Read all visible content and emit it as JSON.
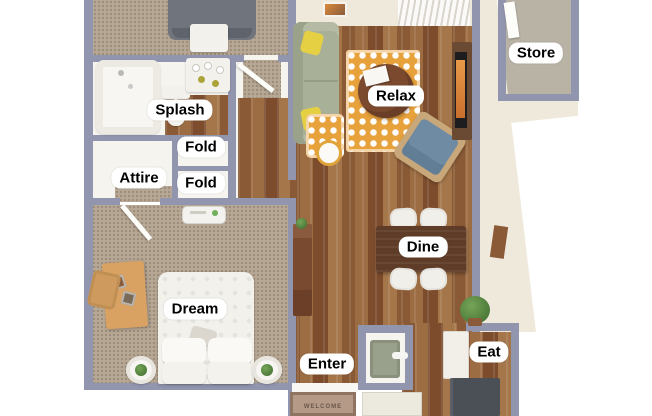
{
  "labels": {
    "store": "Store",
    "splash": "Splash",
    "fold_upper": "Fold",
    "attire": "Attire",
    "fold_lower": "Fold",
    "relax": "Relax",
    "dine": "Dine",
    "dream": "Dream",
    "enter": "Enter",
    "eat": "Eat"
  },
  "mat": {
    "text": "WELCOME"
  },
  "colors": {
    "wall": "#9295ae",
    "cream": "#efe9dc",
    "carpet": "#b7a795",
    "wood": "#95643c",
    "closet": "#f6f4ef",
    "concrete": "#b9b3a6",
    "rug": "#e8a23c",
    "sofa": "#a9b098",
    "pillow": "#e5cf43",
    "chairBlue": "#6f8ba3",
    "walnut": "#5f3c28",
    "coffee": "#7b4a2e",
    "bedGray": "#70747c",
    "desk": "#d9a263",
    "dresser": "#7a4a30",
    "plant": "#4d7c3a",
    "fridge": "#4b4f56",
    "heater": "#99a08b",
    "matTan": "#b49a87",
    "labelBg": "#ffffff",
    "labelText": "#000000"
  }
}
